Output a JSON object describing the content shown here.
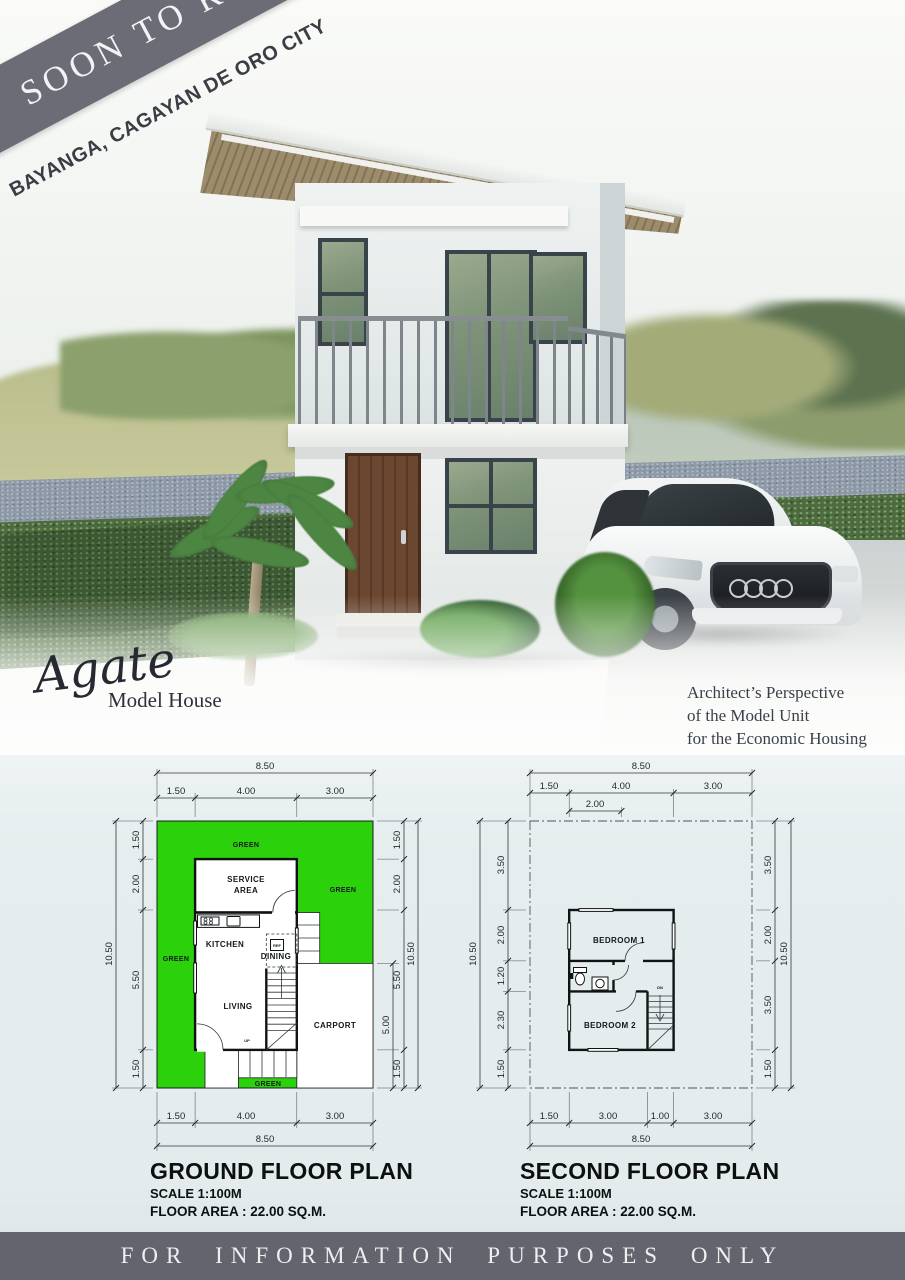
{
  "banner": {
    "ribbon": "SOON TO RISE",
    "location": "BAYANGA, CAGAYAN DE ORO CITY"
  },
  "hero": {
    "model_script": "Agate",
    "model_label": "Model House",
    "caption": {
      "line1": "Architect’s Perspective",
      "line2": "of the Model Unit",
      "line3": "for the Economic Housing"
    }
  },
  "plans": {
    "ground": {
      "title": "GROUND FLOOR PLAN",
      "scale": "SCALE 1:100M",
      "area": "FLOOR AREA : 22.00 SQ.M.",
      "dims": {
        "top_overall": "8.50",
        "top_1": "1.50",
        "top_2": "4.00",
        "top_3": "3.00",
        "bottom_1": "1.50",
        "bottom_2": "4.00",
        "bottom_3": "3.00",
        "bottom_overall": "8.50",
        "left_overall": "10.50",
        "left_1": "1.50",
        "left_2": "2.00",
        "left_3": "5.50",
        "left_4": "1.50",
        "right_1": "1.50",
        "right_2": "2.00",
        "right_3": "5.50",
        "right_4": "1.50",
        "right_overall": "10.50",
        "carport": "5.00"
      },
      "labels": {
        "green_top": "GREEN",
        "green_left": "GREEN",
        "green_right": "GREEN",
        "green_bottom": "GREEN",
        "service_1": "SERVICE",
        "service_2": "AREA",
        "kitchen": "KITCHEN",
        "dining": "DINING",
        "living": "LIVING",
        "carport": "CARPORT",
        "ref": "REF",
        "up": "UP"
      }
    },
    "second": {
      "title": "SECOND FLOOR PLAN",
      "scale": "SCALE 1:100M",
      "area": "FLOOR AREA : 22.00 SQ.M.",
      "dims": {
        "top_overall": "8.50",
        "top_1": "1.50",
        "top_2": "4.00",
        "top_3": "3.00",
        "top_sub": "2.00",
        "bottom_1": "1.50",
        "bottom_2": "3.00",
        "bottom_3": "1.00",
        "bottom_4": "3.00",
        "bottom_overall": "8.50",
        "left_overall": "10.50",
        "left_1": "3.50",
        "left_2": "2.00",
        "left_3": "1.20",
        "left_4": "2.30",
        "left_5": "1.50",
        "right_1": "3.50",
        "right_2": "2.00",
        "right_3": "3.50",
        "right_4": "1.50",
        "right_overall": "10.50"
      },
      "labels": {
        "bedroom1": "BEDROOM 1",
        "bedroom2": "BEDROOM 2",
        "dn": "DN"
      }
    }
  },
  "footer": {
    "text": "FOR INFORMATION PURPOSES ONLY"
  },
  "colors": {
    "green": "#2bd10a",
    "ribbon": "#6c6c77",
    "footer_bar": "#64646e",
    "plan_bg": "#e5edee"
  }
}
